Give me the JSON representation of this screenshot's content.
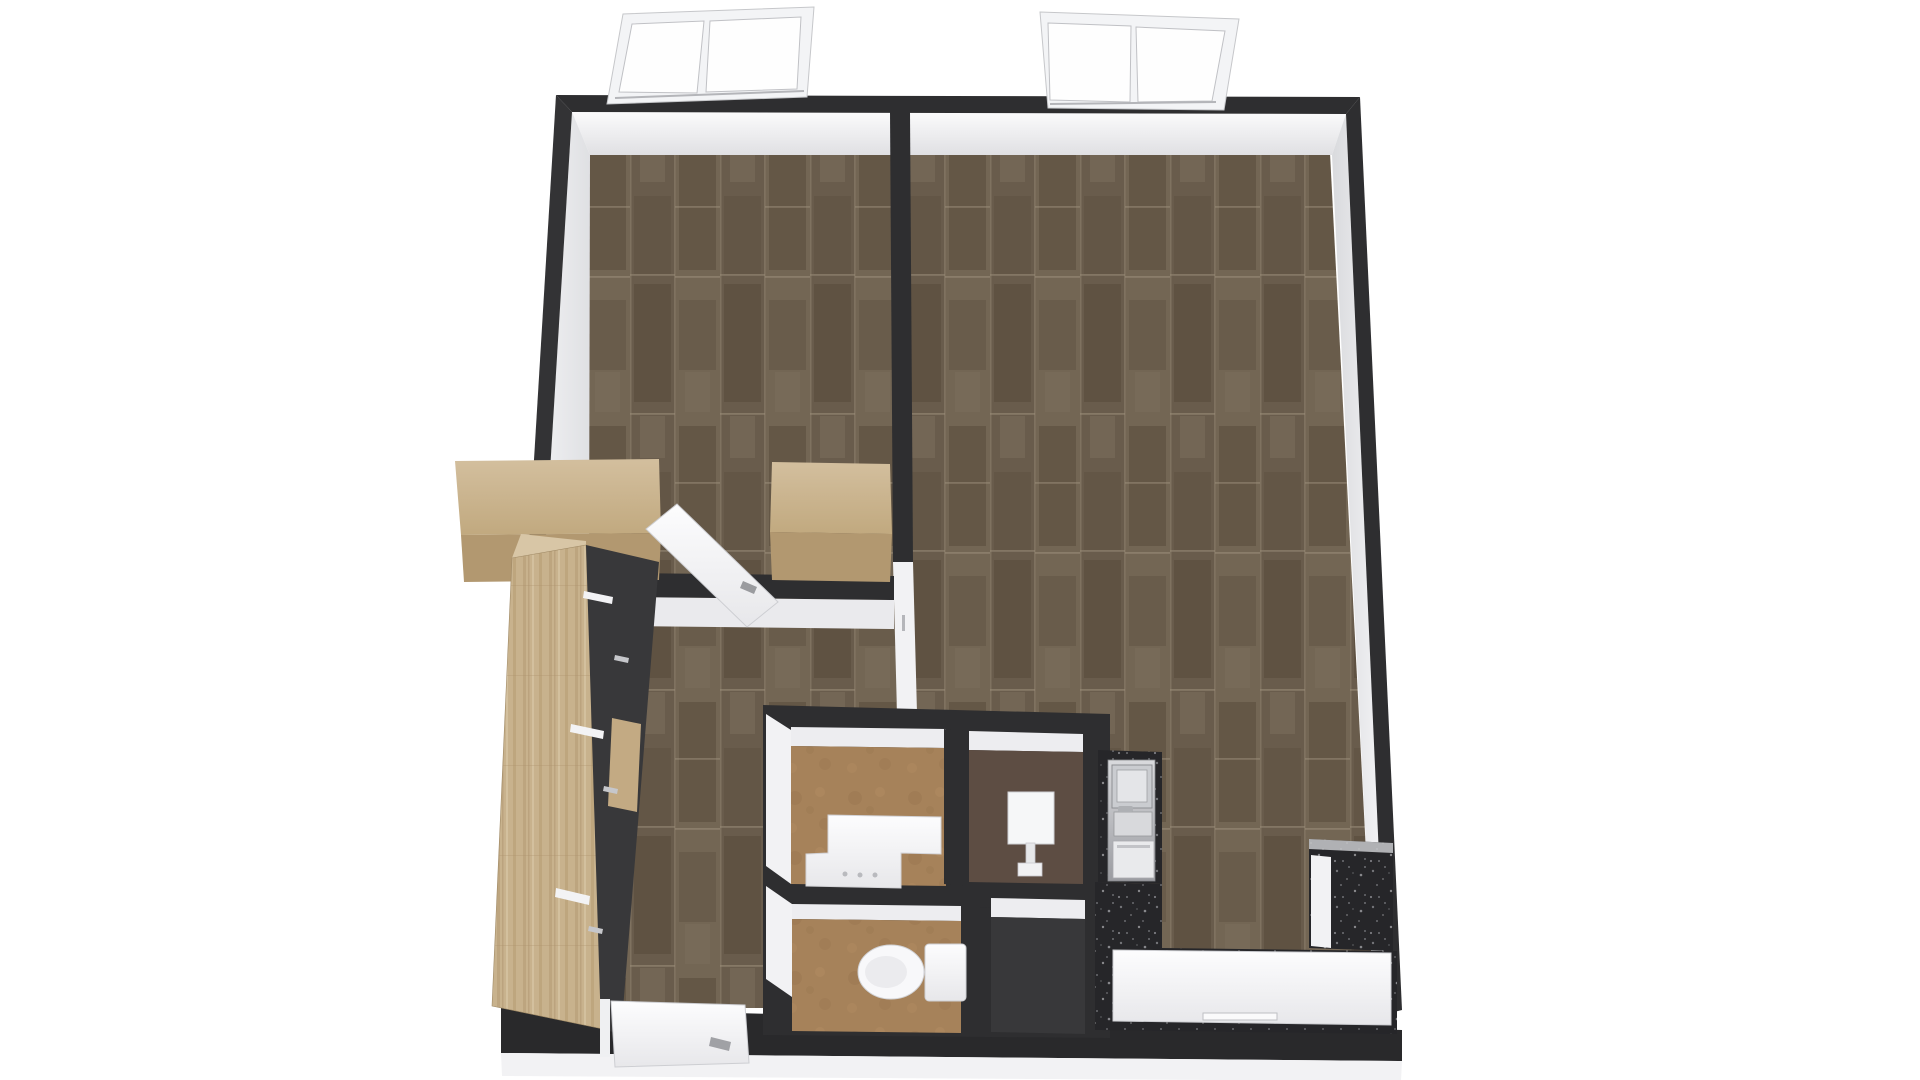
{
  "meta": {
    "description": "3D top-down floor plan render of a one-bedroom apartment with dark walls, wood flooring, wardrobe closet, bathroom block with vanity, washbasin, toilet and shower, and a kitchen with dark speckled counters"
  },
  "scene": {
    "palette": {
      "bg": "#ffffff",
      "wall": "#2e2e30",
      "wallL": "#333335",
      "wallB": "#29292b",
      "faceWhite": "#ededf0",
      "faceBright": "#f2f2f4",
      "plinth": "#f2f2f4",
      "wood": "url(#pWood)",
      "woodV": "url(#pWoodV)",
      "tan": "url(#pTan)",
      "speck": "url(#pSpeck)",
      "brown": "#5d4d43",
      "showerFloor": "#38383a",
      "closet": "#38383a",
      "shelfWood": "#c3aa83",
      "cabFront": "#b29870",
      "woodTop": "url(#gWoodTop)",
      "faceT": "url(#gFaceT)",
      "faceL": "url(#gFaceL)",
      "faceR": "url(#gFaceR)",
      "white": "url(#gWhite)",
      "steel": "url(#gSteel)",
      "frameWhite": "#f3f4f6",
      "pane": "#fefefe",
      "metal": "#c6c7cb",
      "chrome": "#a0a1a5",
      "outline": "#cdced2"
    },
    "shapes": [
      {
        "name": "floor-wood-main",
        "type": "polygon",
        "fill": "wood",
        "attrs": {
          "points": "590,153 1330,153 1374,1008 518,1008"
        }
      },
      {
        "name": "wall-face-top",
        "type": "polygon",
        "fill": "faceT",
        "attrs": {
          "points": "572,112 1346,114 1332,155 590,155"
        }
      },
      {
        "name": "wall-face-left",
        "type": "polygon",
        "fill": "faceL",
        "attrs": {
          "points": "572,112 590,155 588,1008 517,1008"
        }
      },
      {
        "name": "wall-face-right",
        "type": "polygon",
        "fill": "faceR",
        "attrs": {
          "points": "1346,114 1332,155 1374,1008 1386,1014"
        }
      },
      {
        "name": "wall-top",
        "type": "polygon",
        "fill": "wall",
        "attrs": {
          "points": "556,95 1360,97 1346,114 572,112"
        }
      },
      {
        "name": "wall-left",
        "type": "polygon",
        "fill": "wallL",
        "attrs": {
          "points": "556,95 572,112 517,1010 501,1007"
        }
      },
      {
        "name": "wall-right",
        "type": "polygon",
        "fill": "wall",
        "attrs": {
          "points": "1360,97 1402,1010 1386,1014 1346,114"
        }
      },
      {
        "name": "wall-bottom",
        "type": "polygon",
        "fill": "wallB",
        "attrs": {
          "points": "501,1007 1402,1030 1402,1061 501,1053"
        }
      },
      {
        "name": "plinth-bottom",
        "type": "polygon",
        "fill": "plinth",
        "attrs": {
          "points": "501,1053 1402,1061 1401,1081 502,1076"
        }
      },
      {
        "name": "wall-room-divider",
        "type": "polygon",
        "fill": "wall",
        "attrs": {
          "points": "890,112 910,112 913,562 893,562"
        }
      },
      {
        "name": "divider-end-jamb",
        "type": "polygon",
        "fill": "faceBright",
        "attrs": {
          "points": "893,562 913,562 917,713 897,713"
        }
      },
      {
        "name": "divider-door-hinge",
        "type": "rect",
        "fill": "#b5b6ba",
        "attrs": {
          "x": 902,
          "y": 615,
          "width": 3,
          "height": 16
        }
      },
      {
        "name": "wall-bedroom-south",
        "type": "polygon",
        "fill": "wall",
        "attrs": {
          "points": "627,573 894,576 894,600 627,597"
        }
      },
      {
        "name": "bedroom-south-face",
        "type": "polygon",
        "fill": "#eaeaed",
        "attrs": {
          "points": "627,597 894,600 894,629 627,626"
        }
      },
      {
        "name": "bathroom-block-walls",
        "type": "polygon",
        "fill": "wall",
        "attrs": {
          "points": "763,705 1110,714 1110,1038 763,1035"
        }
      },
      {
        "name": "vanity-room-north-face",
        "type": "polygon",
        "fill": "faceWhite",
        "attrs": {
          "points": "791,727 946,729 946,748 791,746"
        }
      },
      {
        "name": "vanity-room-floor",
        "type": "polygon",
        "fill": "tan",
        "attrs": {
          "points": "791,746 946,748 946,886 791,884"
        }
      },
      {
        "name": "vanity-room-west-face",
        "type": "polygon",
        "fill": "faceBright",
        "attrs": {
          "points": "766,714 791,730 791,884 766,866"
        }
      },
      {
        "name": "wall-vanity-basin-divider",
        "type": "polygon",
        "fill": "wall",
        "attrs": {
          "points": "944,729 969,731 969,886 944,884"
        }
      },
      {
        "name": "basin-room-north-face",
        "type": "polygon",
        "fill": "faceWhite",
        "attrs": {
          "points": "969,731 1083,734 1083,752 969,750"
        }
      },
      {
        "name": "basin-room-floor",
        "type": "polygon",
        "fill": "brown",
        "attrs": {
          "points": "969,750 1083,752 1083,884 969,882"
        }
      },
      {
        "name": "wall-bath-middle",
        "type": "polygon",
        "fill": "wall",
        "attrs": {
          "points": "763,884 1085,888 1085,908 763,906"
        }
      },
      {
        "name": "toilet-room-west-jamb",
        "type": "polygon",
        "fill": "faceBright",
        "attrs": {
          "points": "766,886 792,904 792,997 766,979"
        }
      },
      {
        "name": "toilet-room-north-face",
        "type": "polygon",
        "fill": "faceWhite",
        "attrs": {
          "points": "792,904 961,906 961,921 792,919"
        }
      },
      {
        "name": "toilet-room-floor",
        "type": "polygon",
        "fill": "tan",
        "attrs": {
          "points": "792,919 961,921 961,1033 792,1031"
        }
      },
      {
        "name": "wall-toilet-shower-divider",
        "type": "polygon",
        "fill": "wall",
        "attrs": {
          "points": "961,906 991,908 991,1035 961,1033"
        }
      },
      {
        "name": "shower-room-north-face",
        "type": "polygon",
        "fill": "faceWhite",
        "attrs": {
          "points": "991,898 1085,900 1085,919 991,917"
        }
      },
      {
        "name": "shower-room-floor",
        "type": "polygon",
        "fill": "showerFloor",
        "attrs": {
          "points": "991,917 1085,919 1085,1034 991,1032"
        }
      },
      {
        "name": "kitchen-counter-north",
        "type": "polygon",
        "fill": "speck",
        "attrs": {
          "points": "1098,750 1162,752 1162,884 1098,882"
        }
      },
      {
        "name": "kitchen-counter-L",
        "type": "polygon",
        "fill": "speck",
        "attrs": {
          "points": "1095,882 1162,884 1162,948 1397,951 1397,1034 1095,1030"
        }
      },
      {
        "name": "kitchen-tall-unit",
        "type": "rect",
        "fill": "steel",
        "stroke": "#88898d",
        "attrs": {
          "x": 1108,
          "y": 760,
          "width": 47,
          "height": 121,
          "stroke-width": 0.8
        }
      },
      {
        "name": "kitchen-oven",
        "type": "rect",
        "fill": "#caccd0",
        "stroke": "#8e8f93",
        "attrs": {
          "x": 1112,
          "y": 765,
          "width": 40,
          "height": 43,
          "stroke-width": 1
        }
      },
      {
        "name": "kitchen-oven-door",
        "type": "rect",
        "fill": "#e4e5e8",
        "stroke": "#9fa0a4",
        "attrs": {
          "x": 1117,
          "y": 770,
          "width": 30,
          "height": 32,
          "stroke-width": 0.8
        }
      },
      {
        "name": "kitchen-sink",
        "type": "rect",
        "fill": "#d8d9dc",
        "stroke": "#97989c",
        "attrs": {
          "x": 1114,
          "y": 812,
          "width": 38,
          "height": 24,
          "stroke-width": 0.8
        }
      },
      {
        "name": "kitchen-faucet",
        "type": "rect",
        "fill": "#aeb0b4",
        "attrs": {
          "x": 1118,
          "y": 806,
          "width": 15,
          "height": 6,
          "rx": 2
        }
      },
      {
        "name": "kitchen-dishwasher",
        "type": "rect",
        "fill": "#e9eaec",
        "stroke": "#a9aaae",
        "attrs": {
          "x": 1113,
          "y": 841,
          "width": 41,
          "height": 37,
          "stroke-width": 0.8
        }
      },
      {
        "name": "kitchen-dishwasher-panel",
        "type": "rect",
        "fill": "#c2c3c7",
        "attrs": {
          "x": 1117,
          "y": 845,
          "width": 33,
          "height": 3
        }
      },
      {
        "name": "kitchen-white-counter",
        "type": "polygon",
        "fill": "white",
        "stroke": "outline",
        "attrs": {
          "points": "1113,950 1391,953 1391,1025 1113,1021",
          "stroke-width": 1
        }
      },
      {
        "name": "kitchen-counter-handle",
        "type": "rect",
        "fill": "#fafafb",
        "stroke": "#bebfc3",
        "attrs": {
          "x": 1203,
          "y": 1013,
          "width": 74,
          "height": 7,
          "stroke-width": 1
        }
      },
      {
        "name": "kitchen-right-column",
        "type": "polygon",
        "fill": "speck",
        "attrs": {
          "points": "1309,839 1393,843 1393,951 1309,948"
        }
      },
      {
        "name": "kitchen-right-column-top",
        "type": "polygon",
        "fill": "#c9cacd",
        "attrs": {
          "points": "1309,839 1393,843 1393,853 1309,849",
          "opacity": 0.85
        }
      },
      {
        "name": "kitchen-right-column-front",
        "type": "polygon",
        "fill": "faceBright",
        "attrs": {
          "points": "1311,855 1331,857 1331,948 1311,946"
        }
      },
      {
        "name": "vanity-desk",
        "type": "polygon",
        "fill": "white",
        "stroke": "#d3d3d7",
        "attrs": {
          "points": "828,815 941,817 941,854 901,853 901,888 806,886 806,854 828,853",
          "stroke-width": 1
        }
      },
      {
        "name": "vanity-knob-1",
        "type": "circle",
        "fill": "#b9babe",
        "attrs": {
          "cx": 845,
          "cy": 874,
          "r": 2.5
        }
      },
      {
        "name": "vanity-knob-2",
        "type": "circle",
        "fill": "#b9babe",
        "attrs": {
          "cx": 860,
          "cy": 875,
          "r": 2.5
        }
      },
      {
        "name": "vanity-knob-3",
        "type": "circle",
        "fill": "#b9babe",
        "attrs": {
          "cx": 875,
          "cy": 875,
          "r": 2.5
        }
      },
      {
        "name": "washbasin-square",
        "type": "rect",
        "fill": "#f6f7f8",
        "stroke": "#cfd0d4",
        "attrs": {
          "x": 1008,
          "y": 792,
          "width": 46,
          "height": 52,
          "stroke-width": 1
        }
      },
      {
        "name": "washbasin-stem",
        "type": "rect",
        "fill": "#e6e7e9",
        "stroke": "#c8c9cd",
        "attrs": {
          "x": 1026,
          "y": 843,
          "width": 9,
          "height": 21,
          "stroke-width": 0.8
        }
      },
      {
        "name": "washbasin-base",
        "type": "rect",
        "fill": "#f1f1f3",
        "stroke": "#c8c9cd",
        "attrs": {
          "x": 1018,
          "y": 863,
          "width": 24,
          "height": 13,
          "stroke-width": 0.8
        }
      },
      {
        "name": "toilet-tank",
        "type": "rect",
        "fill": "white",
        "stroke": "#cfd0d4",
        "attrs": {
          "x": 925,
          "y": 944,
          "width": 41,
          "height": 57,
          "rx": 4,
          "stroke-width": 1
        }
      },
      {
        "name": "toilet-bowl",
        "type": "ellipse",
        "fill": "#f8f8fa",
        "stroke": "#d2d3d7",
        "attrs": {
          "cx": 891,
          "cy": 972,
          "rx": 33,
          "ry": 27,
          "stroke-width": 1
        }
      },
      {
        "name": "toilet-seat",
        "type": "ellipse",
        "fill": "#ebebee",
        "attrs": {
          "cx": 886,
          "cy": 972,
          "rx": 21,
          "ry": 16
        }
      },
      {
        "name": "cabinet-a-top",
        "type": "polygon",
        "fill": "woodTop",
        "attrs": {
          "points": "455,461 659,459 661,533 461,535"
        }
      },
      {
        "name": "cabinet-a-front",
        "type": "polygon",
        "fill": "cabFront",
        "attrs": {
          "points": "461,535 661,533 659,580 464,582"
        }
      },
      {
        "name": "cabinet-b-top",
        "type": "polygon",
        "fill": "woodTop",
        "attrs": {
          "points": "772,462 890,464 892,534 770,532"
        }
      },
      {
        "name": "cabinet-b-front",
        "type": "polygon",
        "fill": "cabFront",
        "attrs": {
          "points": "770,532 892,534 890,582 772,580"
        }
      },
      {
        "name": "bedroom-door-leaf",
        "type": "polygon",
        "fill": "white",
        "stroke": "outline",
        "attrs": {
          "points": "646,529 677,504 778,602 747,627",
          "stroke-width": 1
        }
      },
      {
        "name": "bedroom-door-handle",
        "type": "polygon",
        "fill": "#9a9b9f",
        "attrs": {
          "points": "743,581 757,587 754,594 740,588"
        }
      },
      {
        "name": "wardrobe-top-cap",
        "type": "polygon",
        "fill": "#d8c6a6",
        "attrs": {
          "points": "512,558 521,534 586,541 586,545"
        }
      },
      {
        "name": "wardrobe-panel",
        "type": "polygon",
        "fill": "woodV",
        "stroke": "#a08a66",
        "attrs": {
          "points": "512,558 586,545 608,1030 492,1006",
          "stroke-width": 0.6
        }
      },
      {
        "name": "closet-interior",
        "type": "polygon",
        "fill": "closet",
        "attrs": {
          "points": "586,545 659,562 621,1034 601,1029"
        }
      },
      {
        "name": "closet-shelf",
        "type": "polygon",
        "fill": "shelfWood",
        "attrs": {
          "points": "612,718 641,724 637,812 608,806"
        }
      },
      {
        "name": "closet-rail-1",
        "type": "polygon",
        "fill": "#f3f3f5",
        "attrs": {
          "points": "584,591 613,597 612,604 583,598"
        }
      },
      {
        "name": "closet-rail-2",
        "type": "polygon",
        "fill": "#f3f3f5",
        "attrs": {
          "points": "571,724 604,731 603,739 570,732"
        }
      },
      {
        "name": "closet-rail-3",
        "type": "polygon",
        "fill": "#f3f3f5",
        "attrs": {
          "points": "556,888 590,896 589,905 555,897"
        }
      },
      {
        "name": "closet-drawer-handle-1",
        "type": "polygon",
        "fill": "metal",
        "attrs": {
          "points": "615,655 629,658 628,663 614,660"
        }
      },
      {
        "name": "closet-drawer-handle-2",
        "type": "polygon",
        "fill": "metal",
        "attrs": {
          "points": "604,786 618,789 617,794 603,791"
        }
      },
      {
        "name": "closet-drawer-handle-3",
        "type": "polygon",
        "fill": "metal",
        "attrs": {
          "points": "589,926 603,929 602,934 588,931"
        }
      },
      {
        "name": "entry-door-frame",
        "type": "rect",
        "fill": "#eff0f2",
        "attrs": {
          "x": 600,
          "y": 999,
          "width": 10,
          "height": 58
        }
      },
      {
        "name": "entry-door-leaf",
        "type": "polygon",
        "fill": "white",
        "stroke": "outline",
        "attrs": {
          "points": "611,1001 745,1005 749,1063 615,1067",
          "stroke-width": 1
        }
      },
      {
        "name": "entry-door-handle",
        "type": "polygon",
        "fill": "chrome",
        "attrs": {
          "points": "711,1037 731,1042 729,1051 709,1046"
        }
      },
      {
        "name": "window-1-frame",
        "type": "polygon",
        "fill": "frameWhite",
        "stroke": "#c6c7ca",
        "attrs": {
          "points": "607,104 623,14 814,7 807,97",
          "stroke-width": 1
        }
      },
      {
        "name": "window-1-pane-left",
        "type": "polygon",
        "fill": "pane",
        "stroke": "#c0c1c5",
        "attrs": {
          "points": "619,92 632,24 704,21 697,93",
          "stroke-width": 1
        }
      },
      {
        "name": "window-1-pane-right",
        "type": "polygon",
        "fill": "pane",
        "stroke": "#c0c1c5",
        "attrs": {
          "points": "706,92 710,21 801,17 797,89",
          "stroke-width": 1
        }
      },
      {
        "name": "window-1-track",
        "type": "line",
        "stroke": "#b4b5b9",
        "attrs": {
          "x1": 615,
          "y1": 98,
          "x2": 804,
          "y2": 91,
          "stroke-width": 2
        }
      },
      {
        "name": "window-2-frame",
        "type": "polygon",
        "fill": "frameWhite",
        "stroke": "#c6c7ca",
        "attrs": {
          "points": "1040,12 1239,19 1224,110 1048,108",
          "stroke-width": 1
        }
      },
      {
        "name": "window-2-pane-left",
        "type": "polygon",
        "fill": "pane",
        "stroke": "#c0c1c5",
        "attrs": {
          "points": "1048,23 1131,26 1130,102 1050,100",
          "stroke-width": 1
        }
      },
      {
        "name": "window-2-pane-right",
        "type": "polygon",
        "fill": "pane",
        "stroke": "#c0c1c5",
        "attrs": {
          "points": "1136,27 1225,31 1212,101 1138,102",
          "stroke-width": 1
        }
      },
      {
        "name": "window-2-track",
        "type": "line",
        "stroke": "#b4b5b9",
        "attrs": {
          "x1": 1050,
          "y1": 104,
          "x2": 1216,
          "y2": 102,
          "stroke-width": 2
        }
      }
    ]
  }
}
